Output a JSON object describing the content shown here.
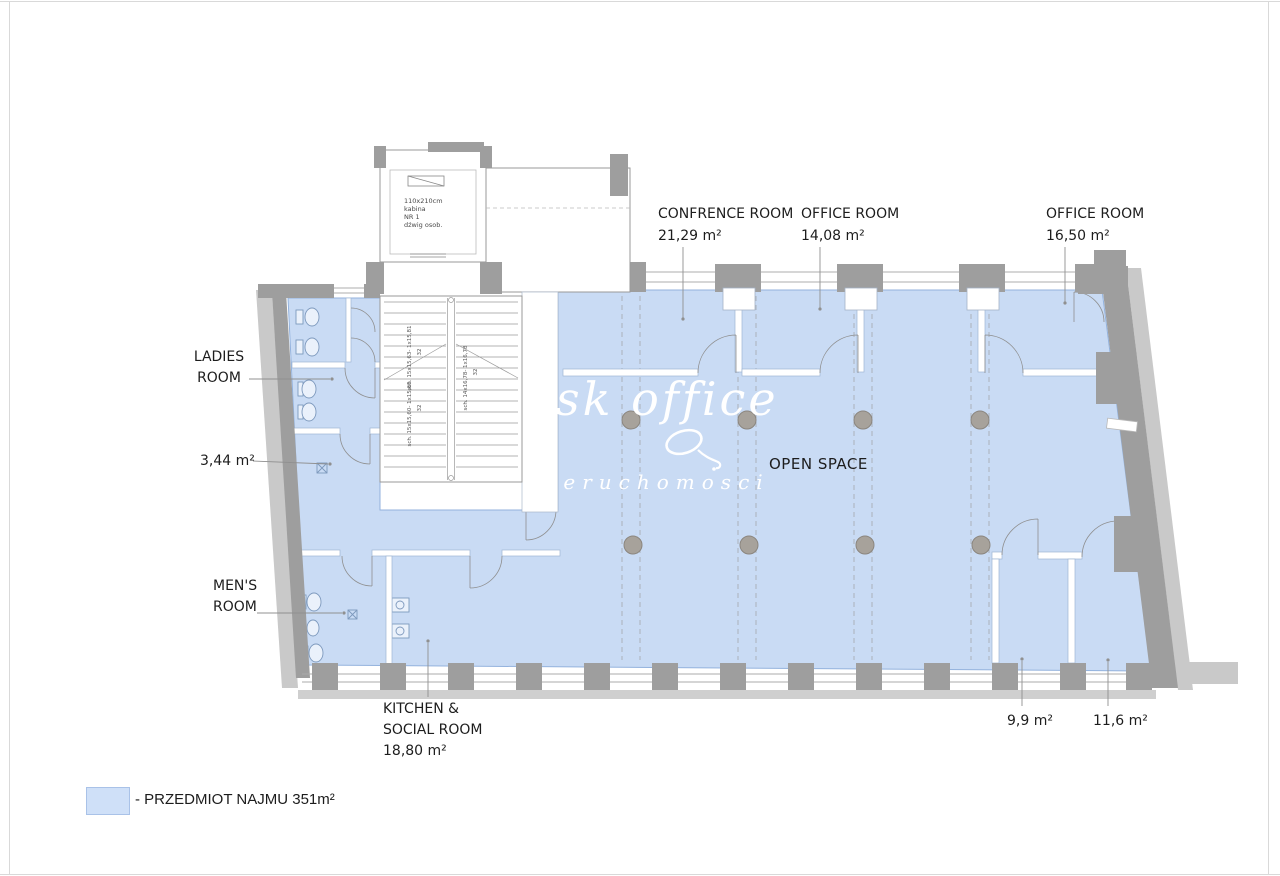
{
  "colors": {
    "rental_fill": "#c9dbf4",
    "rental_border": "#93b2dd",
    "wall_dark": "#9e9e9e",
    "wall_light": "#c9c9c9",
    "column": "#a7a29b",
    "label_text": "#1d1d1d",
    "watermark": "#ffffff"
  },
  "plan": {
    "rooms": {
      "conference": {
        "name": "CONFRENCE ROOM",
        "area": "21,29 m²"
      },
      "office_top": {
        "name": "OFFICE ROOM",
        "area": "14,08 m²"
      },
      "office_right": {
        "name": "OFFICE ROOM",
        "area": "16,50 m²"
      },
      "open_space": {
        "name": "OPEN SPACE"
      },
      "ladies": {
        "line1": "LADIES",
        "line2": "ROOM"
      },
      "ladies_area": {
        "area": "3,44 m²"
      },
      "mens": {
        "line1": "MEN'S",
        "line2": "ROOM"
      },
      "kitchen": {
        "line1": "KITCHEN &",
        "line2": "SOCIAL ROOM",
        "area": "18,80 m²"
      },
      "small_room_left": {
        "area": "9,9 m²"
      },
      "small_room_right": {
        "area": "11,6 m²"
      }
    },
    "elevator_note": "110x210cm\nkabina\nNR 1\ndźwig osob.",
    "stairs": {
      "note_left_upper": "sch. 15x15,63- 1x15,81",
      "note_left_lower": "sch. 15x15,60- 1x15,60",
      "note_right": "sch. 14x16,78- 1x16,78",
      "risers_left_upper": "32",
      "risers_left_lower": "32",
      "risers_right": "32"
    }
  },
  "watermark": {
    "line1": "sk office",
    "line2": "ieruchomosci"
  },
  "legend": {
    "label": "- PRZEDMIOT NAJMU 351m²"
  }
}
